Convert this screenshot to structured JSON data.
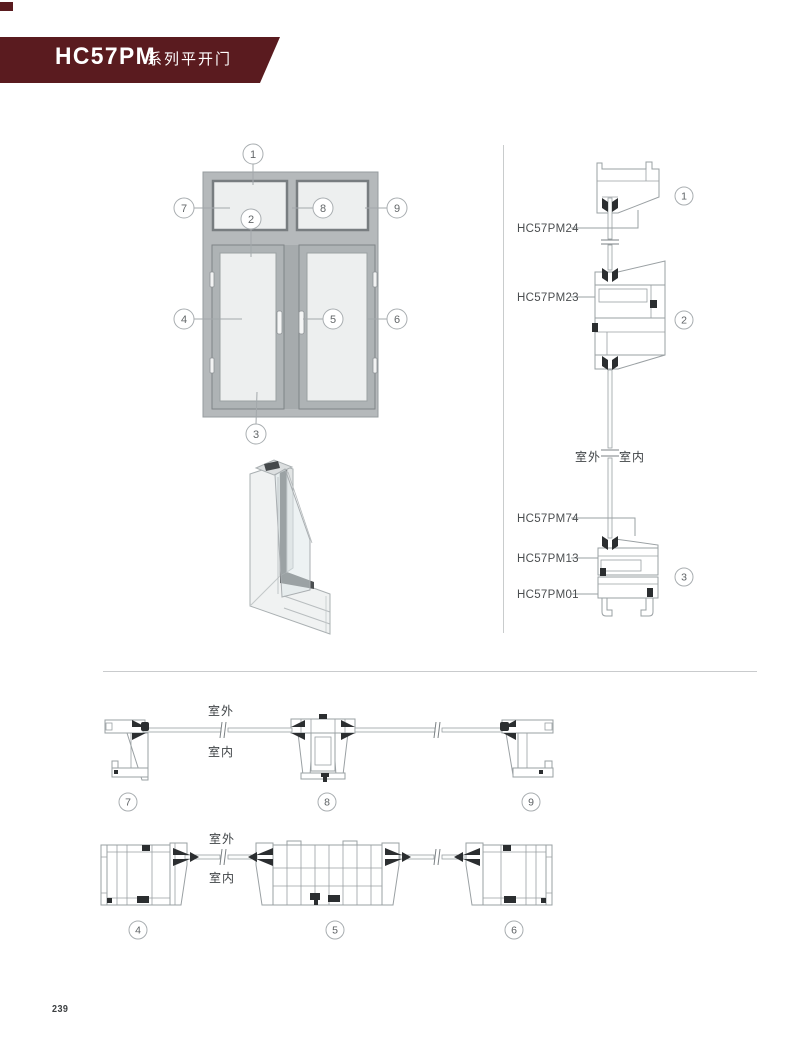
{
  "header": {
    "title": "HC57PM",
    "subtitle": "系列平开门"
  },
  "labels": {
    "outdoor": "室外",
    "indoor": "室内"
  },
  "drawings": {
    "elevation_callouts": [
      "1",
      "2",
      "3",
      "4",
      "5",
      "6",
      "7",
      "8",
      "9"
    ],
    "vertical_section": {
      "labels": [
        "HC57PM24",
        "HC57PM23",
        "HC57PM74",
        "HC57PM13",
        "HC57PM01"
      ],
      "callouts": [
        "1",
        "2",
        "3"
      ]
    },
    "plan_top_callouts": [
      "7",
      "8",
      "9"
    ],
    "plan_bottom_callouts": [
      "4",
      "5",
      "6"
    ]
  },
  "footer": {
    "page_number": "239"
  }
}
